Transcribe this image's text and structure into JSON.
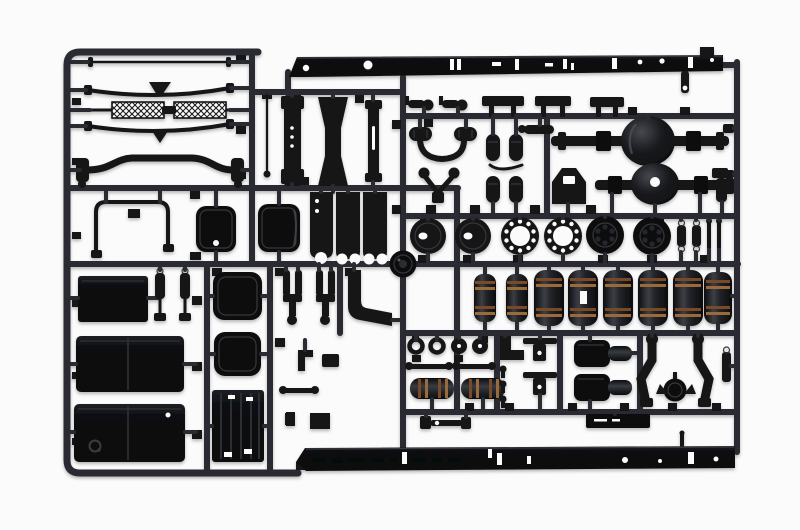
{
  "image": {
    "kind": "product-photo",
    "subject": "black injection-molded plastic model kit sprue with truck chassis parts on a white background"
  },
  "colors": {
    "bg": "#fbfbfb",
    "runner": "#2a2c30",
    "part": "#131417",
    "part-deep": "#0c0d10",
    "edge": "#34373d",
    "rib": "#7a4a28",
    "rib-lite": "#9a6a3a",
    "glint": "#54585e"
  },
  "sprue": {
    "frame": "rounded rectangular runner frame, open lower-right where chassis rail parts form the border",
    "parts": [
      {
        "name": "chassis-rail-top",
        "qty": 1
      },
      {
        "name": "chassis-rail-bottom",
        "qty": 1
      },
      {
        "name": "tie-rod",
        "qty": 1
      },
      {
        "name": "leaf-spring",
        "qty": 2
      },
      {
        "name": "tread-plate-bar-hatched",
        "qty": 1
      },
      {
        "name": "front-axle-beam",
        "qty": 1
      },
      {
        "name": "cab-frame-u-tube",
        "qty": 1
      },
      {
        "name": "air-cleaner-canister-cover",
        "qty": 2
      },
      {
        "name": "antenna-rod",
        "qty": 1
      },
      {
        "name": "cross-member-plate",
        "qty": 1
      },
      {
        "name": "cross-member-hourglass",
        "qty": 1
      },
      {
        "name": "cross-member-strip",
        "qty": 1
      },
      {
        "name": "frame-bracket-scalloped",
        "qty": 3
      },
      {
        "name": "air-horn",
        "qty": 2
      },
      {
        "name": "step-plate",
        "qty": 3
      },
      {
        "name": "engine-mount-u-arm",
        "qty": 1
      },
      {
        "name": "brake-chamber-capsule",
        "qty": 4
      },
      {
        "name": "v-mount-linkage",
        "qty": 1
      },
      {
        "name": "rear-axle-housing-full",
        "qty": 1
      },
      {
        "name": "rear-axle-housing-half",
        "qty": 1
      },
      {
        "name": "cab-mount-trapezoid",
        "qty": 1
      },
      {
        "name": "brake-backing-plate",
        "qty": 2
      },
      {
        "name": "hub-ring-flange",
        "qty": 2
      },
      {
        "name": "brake-drum",
        "qty": 2
      },
      {
        "name": "turnbuckle-link",
        "qty": 2
      },
      {
        "name": "pin-rod",
        "qty": 2
      },
      {
        "name": "hub-cap-disc",
        "qty": 1
      },
      {
        "name": "air-tank-cylinder",
        "qty": 8
      },
      {
        "name": "step-panel",
        "qty": 1
      },
      {
        "name": "shock-absorber",
        "qty": 2
      },
      {
        "name": "fuel-tank-half",
        "qty": 2
      },
      {
        "name": "battery-box-lid",
        "qty": 2
      },
      {
        "name": "ribbed-mudflap-panel",
        "qty": 1
      },
      {
        "name": "brake-caliper-fork",
        "qty": 2
      },
      {
        "name": "suspension-l-arm",
        "qty": 1
      },
      {
        "name": "ring-grommet",
        "qty": 4
      },
      {
        "name": "link-bar",
        "qty": 2
      },
      {
        "name": "air-filter-cylinder",
        "qty": 2
      },
      {
        "name": "elbow-pipe",
        "qty": 2
      },
      {
        "name": "cross-mount-bracket",
        "qty": 2
      },
      {
        "name": "gearbox-block",
        "qty": 2
      },
      {
        "name": "fifth-wheel-arm",
        "qty": 2
      },
      {
        "name": "spare-wheel-disc",
        "qty": 1
      },
      {
        "name": "heat-shield-bar",
        "qty": 1
      },
      {
        "name": "drag-link",
        "qty": 1
      }
    ]
  }
}
